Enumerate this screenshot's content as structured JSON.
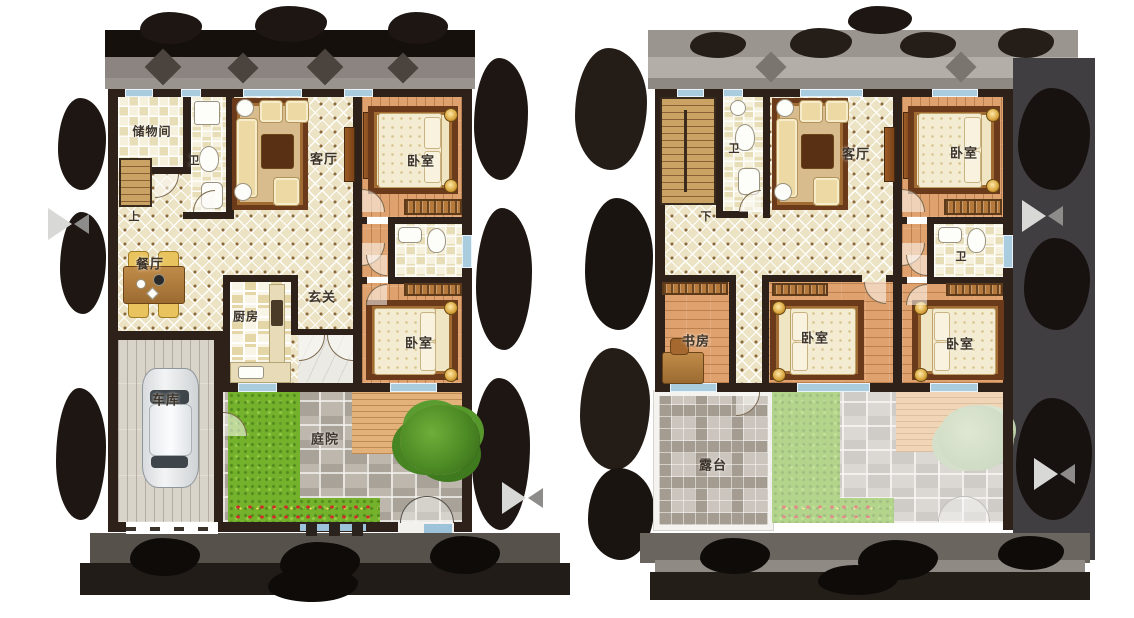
{
  "floors": [
    {
      "id": "left_plan",
      "stair_label": "上",
      "rooms": [
        {
          "label": "储物间"
        },
        {
          "label": "卫"
        },
        {
          "label": "客厅"
        },
        {
          "label": "卧室"
        },
        {
          "label": "餐厅"
        },
        {
          "label": "厨房"
        },
        {
          "label": "玄关"
        },
        {
          "label": "卧室"
        },
        {
          "label": "车库"
        },
        {
          "label": "庭院"
        }
      ]
    },
    {
      "id": "right_plan",
      "stair_label": "下",
      "rooms": [
        {
          "label": "卫"
        },
        {
          "label": "客厅"
        },
        {
          "label": "卧室"
        },
        {
          "label": "卫"
        },
        {
          "label": "书房"
        },
        {
          "label": "卧室"
        },
        {
          "label": "卧室"
        },
        {
          "label": "露台"
        }
      ]
    }
  ],
  "colors": {
    "wall": "#2d2119",
    "diamond_tile": "#ece3c4",
    "wood_floor": "#dfa26e",
    "window": "#a9cddf",
    "grass": "#74b22c",
    "paver": "#b3ada4",
    "deck": "#e3b27a",
    "terrace_tile": "#cbc5bd",
    "marble": "#eceae5",
    "dark_trees": "#1d1612"
  }
}
